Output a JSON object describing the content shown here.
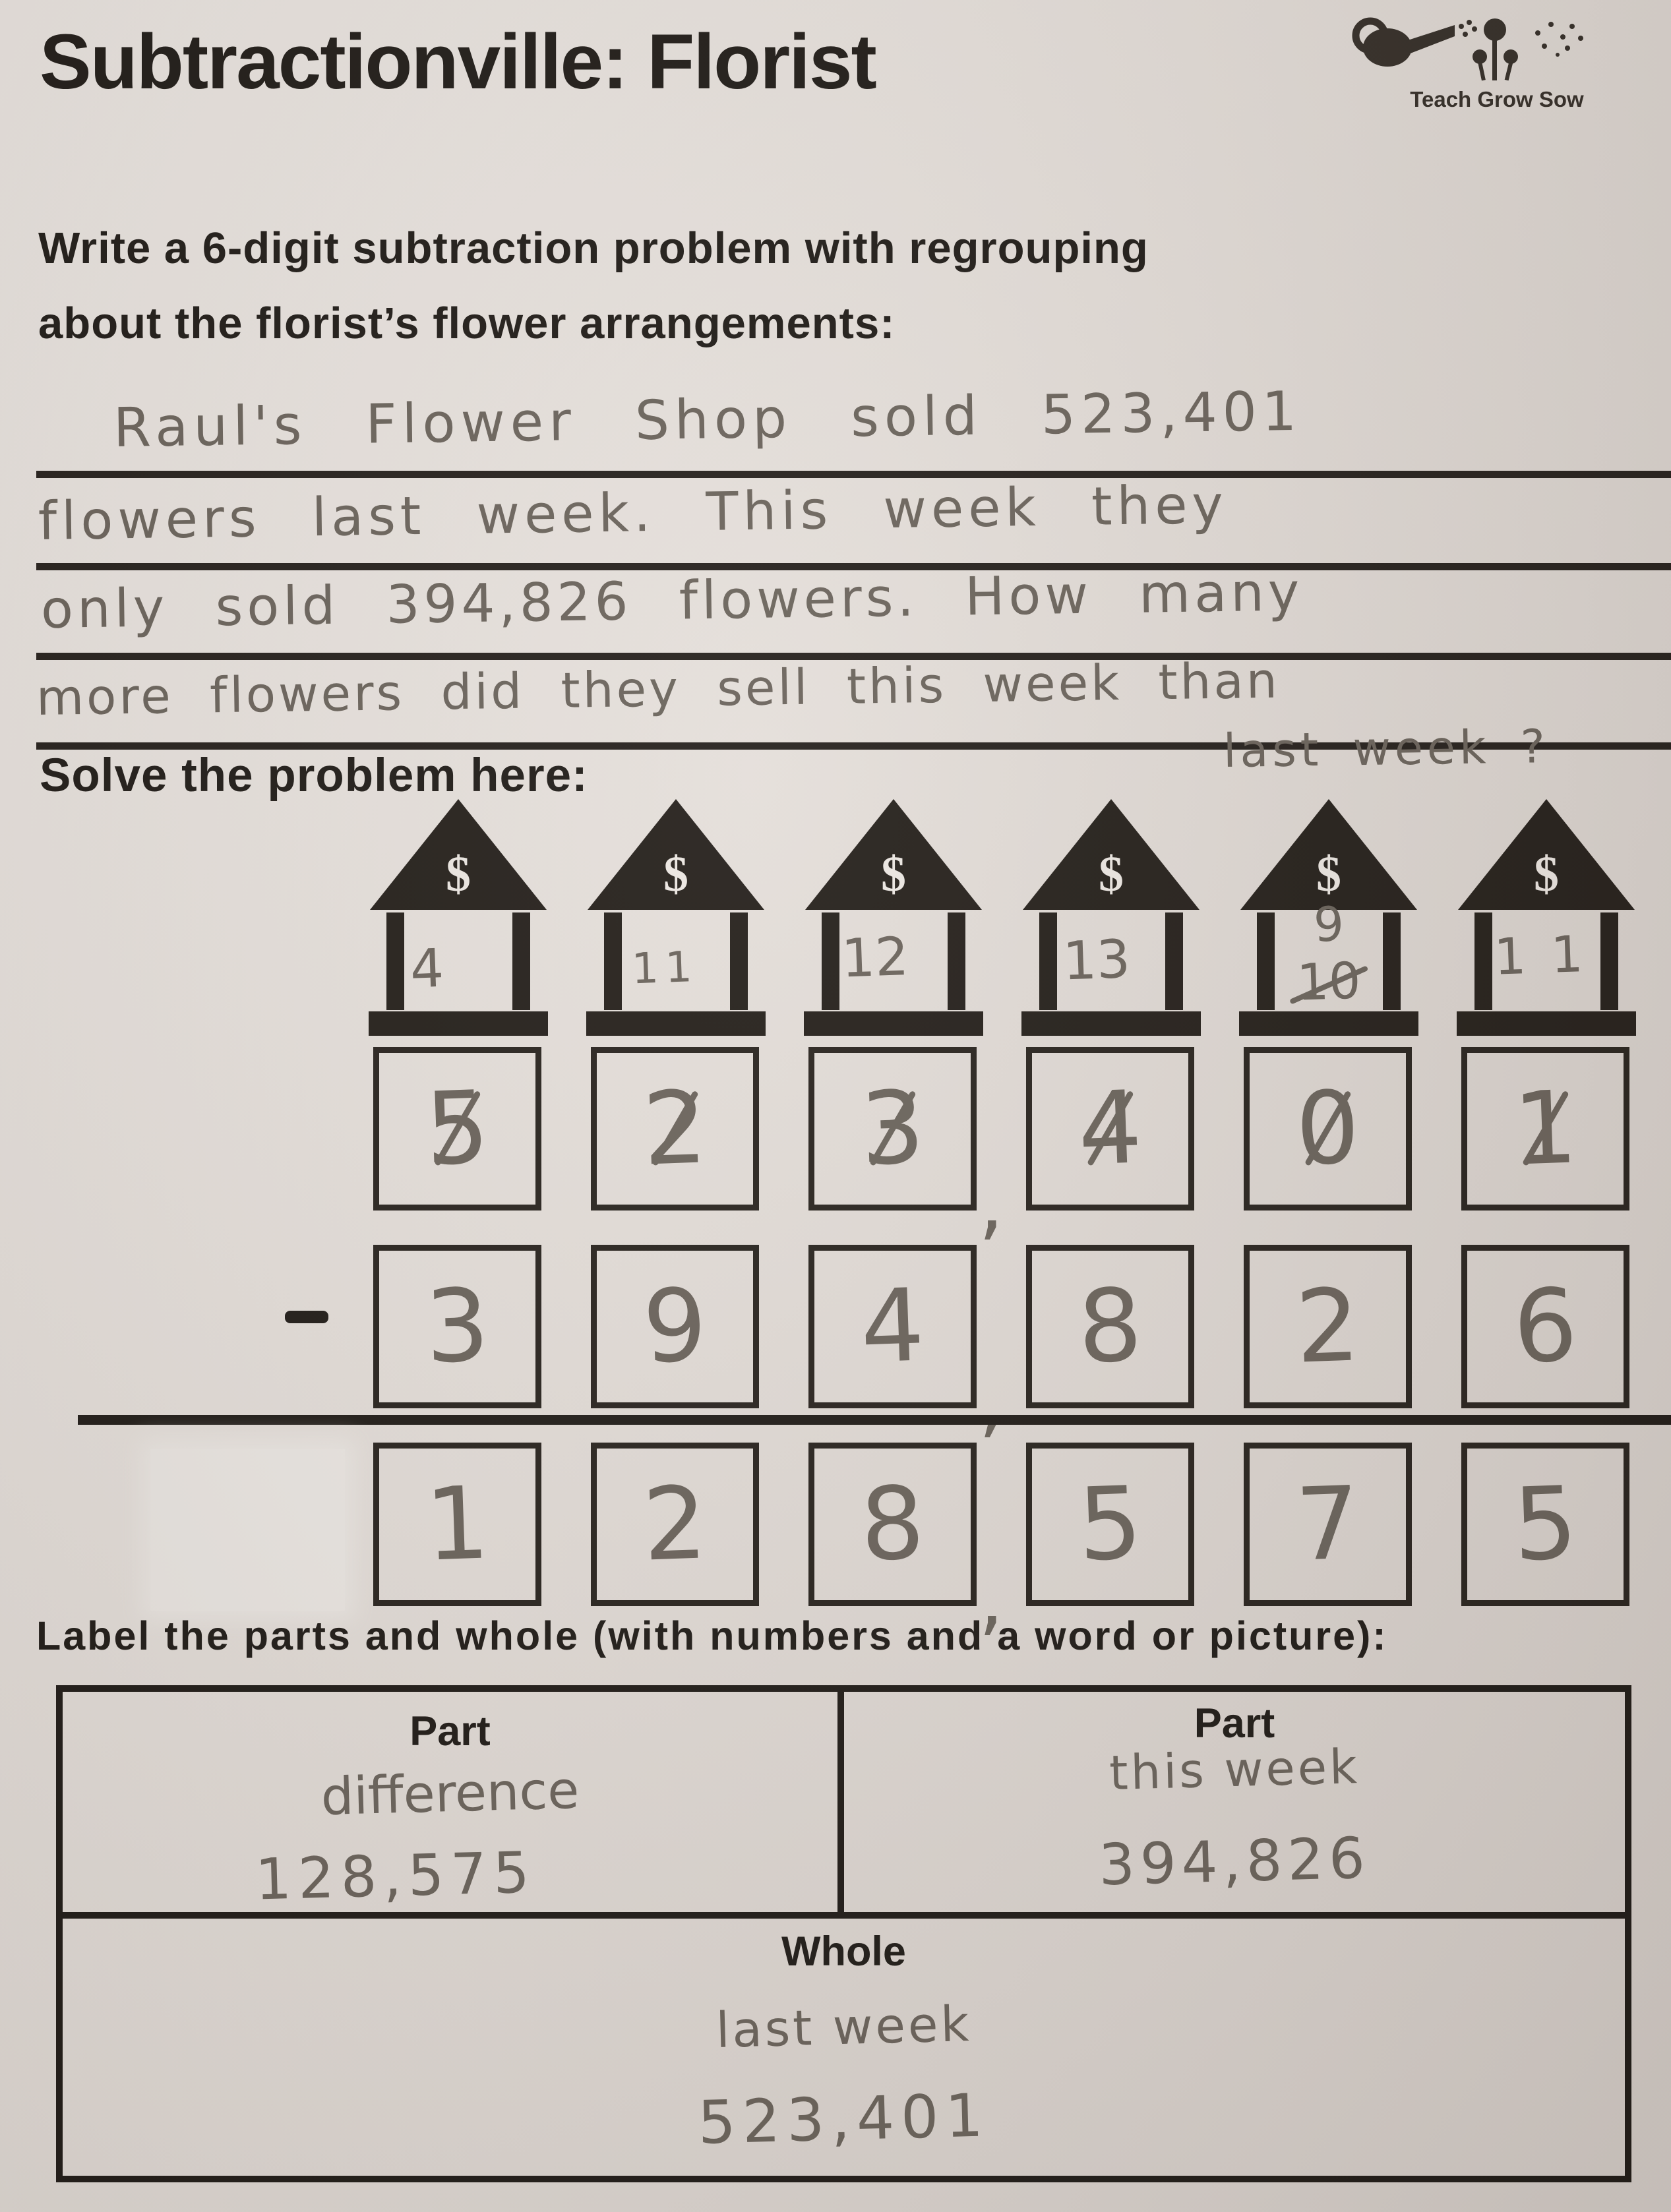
{
  "page": {
    "title": "Subtractionville: Florist"
  },
  "logo": {
    "caption": "Teach Grow Sow"
  },
  "prompt": {
    "line1": "Write a 6-digit subtraction problem with regrouping",
    "line2": "about the florist’s flower arrangements:"
  },
  "story": {
    "line1": "Raul's Flower Shop sold 523,401",
    "line2": "flowers last week. This week they",
    "line3": "only sold 394,826 flowers. How many",
    "line4": "more flowers did they sell this week than",
    "line5": "last week ?"
  },
  "solve": {
    "heading": "Solve the problem here:",
    "bank_symbol": "$",
    "banks": [
      {
        "note": "4"
      },
      {
        "note": "11"
      },
      {
        "note": "12"
      },
      {
        "note": "13"
      },
      {
        "note": "9",
        "crossed": "10"
      },
      {
        "note": "11"
      }
    ],
    "minuend": [
      "5",
      "2",
      "3",
      "4",
      "0",
      "1"
    ],
    "subtrahend": [
      "3",
      "9",
      "4",
      "8",
      "2",
      "6"
    ],
    "difference": [
      "1",
      "2",
      "8",
      "5",
      "7",
      "5"
    ],
    "comma": ","
  },
  "labels": {
    "heading": "Label the parts and whole (with numbers and a word or picture):",
    "part_left": {
      "header": "Part",
      "word": "difference",
      "number": "128,575"
    },
    "part_right": {
      "header": "Part",
      "word": "this week",
      "number": "394,826"
    },
    "whole": {
      "header": "Whole",
      "word": "last week",
      "number": "523,401"
    }
  },
  "colors": {
    "paper": "#e3ddd8",
    "ink": "#1d1915",
    "pencil": "#69625a"
  }
}
